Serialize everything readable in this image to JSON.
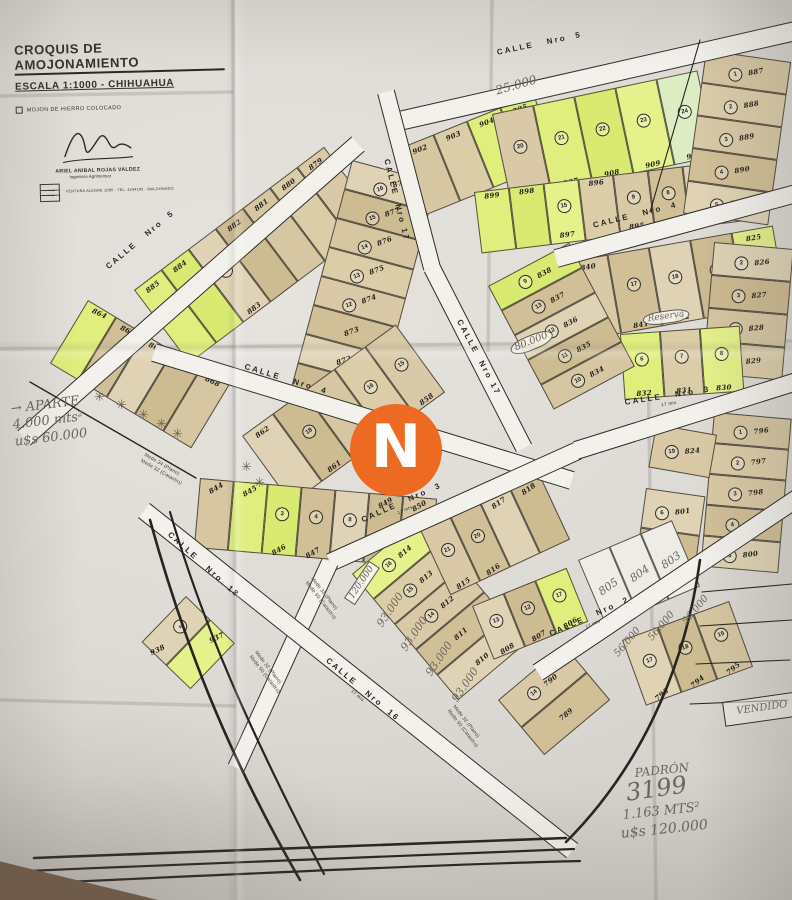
{
  "title_block": {
    "title": "CROQUIS DE AMOJONAMIENTO",
    "subtitle": "ESCALA 1:1000   -   CHIHUAHUA",
    "legend_note": "MOJON DE HIERRO COLOCADO",
    "surveyor_name": "ARIEL ANIBAL ROJAS VALDEZ",
    "surveyor_title": "Ingeniero Agrimensor",
    "surveyor_contact": "VENTURA ALEGRE 1085  -  TEL. 4244100  -  MALDONADO"
  },
  "watermark": {
    "letter": "N",
    "bg": "#EC6A21",
    "fg": "#FFFFFF"
  },
  "palette": {
    "paper": "#e0ddd8",
    "street": "#f3f1ec",
    "line": "#2c2a26",
    "pencil": "#6b655c",
    "tan": [
      "#d9c9a6",
      "#d1bf97",
      "#e0d3b5",
      "#cdbb92",
      "#d6c6a2",
      "#dccda9"
    ],
    "hl": [
      "#e0ee7e",
      "#d9ea72",
      "#e5f18a",
      "#dcedc4"
    ],
    "white_lot": "#eeece7"
  },
  "streets": {
    "bands": [
      {
        "id": "calle-5-top",
        "x1": 386,
        "y1": 124,
        "x2": 800,
        "y2": 30,
        "w": 20
      },
      {
        "id": "calle-5-left",
        "x1": 24,
        "y1": 438,
        "x2": 358,
        "y2": 144,
        "w": 20
      },
      {
        "id": "calle-17-a",
        "x1": 386,
        "y1": 92,
        "x2": 432,
        "y2": 268,
        "w": 18
      },
      {
        "id": "calle-17-b",
        "x1": 432,
        "y1": 268,
        "x2": 524,
        "y2": 448,
        "w": 18
      },
      {
        "id": "calle-4-center",
        "x1": 154,
        "y1": 352,
        "x2": 572,
        "y2": 480,
        "w": 19
      },
      {
        "id": "calle-4-right",
        "x1": 556,
        "y1": 258,
        "x2": 800,
        "y2": 192,
        "w": 19
      },
      {
        "id": "calle-3-center",
        "x1": 578,
        "y1": 450,
        "x2": 330,
        "y2": 562,
        "w": 19
      },
      {
        "id": "calle-3-ext",
        "x1": 330,
        "y1": 562,
        "x2": 236,
        "y2": 768,
        "w": 18
      },
      {
        "id": "calle-3-right",
        "x1": 576,
        "y1": 450,
        "x2": 800,
        "y2": 380,
        "w": 19
      },
      {
        "id": "calle-2",
        "x1": 538,
        "y1": 672,
        "x2": 800,
        "y2": 496,
        "w": 19
      },
      {
        "id": "calle-18-16",
        "x1": 144,
        "y1": 510,
        "x2": 572,
        "y2": 850,
        "w": 19
      }
    ],
    "labels": [
      {
        "text": "CALLE   Nro  5",
        "x": 496,
        "y": 48,
        "rot": -12
      },
      {
        "text": "CALLE   Nro  5",
        "x": 104,
        "y": 264,
        "rot": -40
      },
      {
        "text": "CALLE  Nro 17",
        "x": 391,
        "y": 158,
        "rot": 76
      },
      {
        "text": "CALLE  Nro 17",
        "x": 463,
        "y": 318,
        "rot": 62
      },
      {
        "text": "CALLE   Nro  4",
        "x": 246,
        "y": 362,
        "rot": 17
      },
      {
        "text": "CALLE   Nro  4",
        "x": 592,
        "y": 221,
        "rot": -14
      },
      {
        "text": "CALLE   Nro  3",
        "x": 360,
        "y": 516,
        "rot": -24,
        "wnote": "17 mts"
      },
      {
        "text": "CALLE   Nro  3",
        "x": 624,
        "y": 398,
        "rot": -9,
        "wnote": "17 mts"
      },
      {
        "text": "CALLE   Nro  2",
        "x": 548,
        "y": 630,
        "rot": -24,
        "wnote": "17 mts"
      },
      {
        "text": "CALLE   Nro  18",
        "x": 172,
        "y": 530,
        "rot": 42
      },
      {
        "text": "CALLE   Nro  16",
        "x": 330,
        "y": 656,
        "rot": 40,
        "wnote": "17 mts"
      }
    ]
  },
  "blocks": [
    {
      "id": "mz-879-885",
      "x": 134,
      "y": 290,
      "rot": -37,
      "pw": 34,
      "ph": 92,
      "lots": [
        {
          "n": "885",
          "hl": 1
        },
        {
          "n": "884",
          "hl": 1
        },
        {
          "n": "883",
          "c": "21"
        },
        {
          "n": "882"
        },
        {
          "n": "881"
        },
        {
          "n": "880"
        },
        {
          "n": "879"
        }
      ]
    },
    {
      "id": "col-871-878",
      "x": 352,
      "y": 160,
      "rot": 15,
      "type": "col",
      "cw": 88,
      "ch": 30,
      "ttilt": -35,
      "lots": [
        {
          "n": "878",
          "c": "16"
        },
        {
          "n": "877",
          "c": "15"
        },
        {
          "n": "876",
          "c": "14"
        },
        {
          "n": "875",
          "c": "13"
        },
        {
          "n": "874",
          "c": "12"
        },
        {
          "n": "873"
        },
        {
          "n": "872"
        },
        {
          "n": "871"
        }
      ]
    },
    {
      "id": "mz-902-905",
      "x": 400,
      "y": 148,
      "rot": -22,
      "pw": 36,
      "ph": 72,
      "lots": [
        {
          "n": "902"
        },
        {
          "n": "903"
        },
        {
          "n": "904",
          "hl": 1
        },
        {
          "n": "905",
          "hl": 1
        }
      ]
    },
    {
      "id": "mz-906-910",
      "x": 492,
      "y": 114,
      "rot": -12,
      "pw": 42,
      "ph": 88,
      "lots": [
        {
          "n": "906",
          "c": "20"
        },
        {
          "n": "907",
          "c": "21",
          "hl": 1
        },
        {
          "n": "908",
          "c": "22",
          "hl": 1
        },
        {
          "n": "909",
          "c": "23",
          "hl": 1
        },
        {
          "n": "910",
          "c": "24",
          "hl": 1
        }
      ]
    },
    {
      "id": "mz-892-899",
      "x": 474,
      "y": 192,
      "rot": -7,
      "pw": 35,
      "ph": 62,
      "lpos": "bottom",
      "lots": [
        {
          "n": "899",
          "hl": 1
        },
        {
          "n": "898",
          "hl": 1
        },
        {
          "n": "897",
          "c": "15",
          "hl": 1
        },
        {
          "n": "896"
        },
        {
          "n": "895",
          "c": "9"
        },
        {
          "n": "894",
          "c": "8"
        },
        {
          "n": "893"
        },
        {
          "n": "892"
        }
      ]
    },
    {
      "id": "col-887-891",
      "x": 706,
      "y": 50,
      "rot": 8,
      "type": "col",
      "cw": 86,
      "ch": 33,
      "ttilt": -18,
      "lots": [
        {
          "n": "887",
          "c": "1"
        },
        {
          "n": "888",
          "c": "2"
        },
        {
          "n": "889",
          "c": "3"
        },
        {
          "n": "890",
          "c": "4"
        },
        {
          "n": "891",
          "c": "5"
        }
      ]
    },
    {
      "id": "mz-840-825",
      "x": 566,
      "y": 262,
      "rot": -10,
      "pw": 42,
      "ph": 80,
      "lots": [
        {
          "n": "840"
        },
        {
          "n": "841",
          "c": "17"
        },
        {
          "n": "842",
          "c": "18"
        },
        {
          "n": "843",
          "c": "19"
        },
        {
          "n": "825",
          "hl": 1
        }
      ]
    },
    {
      "id": "col-826-829",
      "x": 714,
      "y": 242,
      "rot": 5,
      "type": "col",
      "cw": 80,
      "ch": 33,
      "ttilt": -10,
      "lots": [
        {
          "n": "826",
          "c": "2"
        },
        {
          "n": "827",
          "c": "3"
        },
        {
          "n": "828",
          "c": "4"
        },
        {
          "n": "829",
          "c": "5"
        }
      ]
    },
    {
      "id": "mz-830-832",
      "x": 620,
      "y": 334,
      "rot": -4,
      "pw": 40,
      "ph": 66,
      "lots": [
        {
          "n": "832",
          "c": "6",
          "hl": 1
        },
        {
          "n": "831",
          "c": "7"
        },
        {
          "n": "830",
          "c": "8",
          "hl": 1
        }
      ]
    },
    {
      "id": "col-834-838",
      "x": 488,
      "y": 286,
      "rot": -28,
      "type": "col",
      "cw": 92,
      "ch": 28,
      "lots": [
        {
          "n": "838",
          "c": "9",
          "hl": 1
        },
        {
          "n": "837",
          "c": "13"
        },
        {
          "n": "836",
          "c": "12"
        },
        {
          "n": "835",
          "c": "11"
        },
        {
          "n": "834",
          "c": "10"
        }
      ]
    },
    {
      "id": "mz-858-862",
      "x": 242,
      "y": 436,
      "rot": -36,
      "pw": 38,
      "ph": 84,
      "lots": [
        {
          "n": "862"
        },
        {
          "n": "861",
          "c": "18"
        },
        {
          "n": "860",
          "c": "17"
        },
        {
          "n": "859",
          "c": "16"
        },
        {
          "n": "858",
          "c": "15"
        }
      ]
    },
    {
      "id": "mz-844-850",
      "x": 200,
      "y": 478,
      "rot": 5,
      "ttilt": -35,
      "pw": 34,
      "ph": 70,
      "lots": [
        {
          "n": "844"
        },
        {
          "n": "845",
          "hl": 1
        },
        {
          "n": "846",
          "c": "3",
          "hl": 1
        },
        {
          "n": "847",
          "c": "4"
        },
        {
          "n": "848",
          "c": "8"
        },
        {
          "n": "849"
        },
        {
          "n": "850"
        }
      ]
    },
    {
      "id": "mz-864-868",
      "x": 88,
      "y": 300,
      "rot": 31,
      "ttilt": -6,
      "pw": 33,
      "ph": 74,
      "lpos": "bottom",
      "lots": [
        {
          "n": "864",
          "hl": 1
        },
        {
          "n": "865"
        },
        {
          "n": "866"
        },
        {
          "n": "867"
        },
        {
          "n": "868"
        }
      ]
    },
    {
      "id": "mz-937-938",
      "x": 186,
      "y": 596,
      "rot": 44,
      "ttilt": -70,
      "pw": 34,
      "ph": 64,
      "lots": [
        {
          "n": "938",
          "c": "3"
        },
        {
          "n": "937",
          "hl": 1
        }
      ]
    },
    {
      "id": "col-810-814",
      "x": 352,
      "y": 574,
      "rot": -40,
      "type": "col",
      "cw": 90,
      "ch": 33,
      "lots": [
        {
          "n": "814",
          "c": "16",
          "hl": 1
        },
        {
          "n": "813",
          "c": "15"
        },
        {
          "n": "812",
          "c": "14"
        },
        {
          "n": "811"
        },
        {
          "n": "810"
        }
      ]
    },
    {
      "id": "col-789-790",
      "x": 498,
      "y": 700,
      "rot": -40,
      "type": "col",
      "cw": 86,
      "ch": 36,
      "lots": [
        {
          "n": "790",
          "c": "14"
        },
        {
          "n": "789"
        }
      ]
    },
    {
      "id": "mz-793-795",
      "x": 622,
      "y": 640,
      "rot": -20,
      "ttilt": -20,
      "pw": 38,
      "ph": 70,
      "lots": [
        {
          "n": "793",
          "c": "17"
        },
        {
          "n": "794",
          "c": "18"
        },
        {
          "n": "795",
          "c": "19"
        }
      ]
    },
    {
      "id": "col-796-800",
      "x": 714,
      "y": 412,
      "rot": 5,
      "type": "col",
      "cw": 78,
      "ch": 31,
      "ttilt": -12,
      "lots": [
        {
          "n": "796",
          "c": "1"
        },
        {
          "n": "797",
          "c": "2"
        },
        {
          "n": "798",
          "c": "3"
        },
        {
          "n": "799",
          "c": "4"
        },
        {
          "n": "800",
          "c": "5"
        }
      ]
    },
    {
      "id": "lot-824",
      "x": 656,
      "y": 424,
      "rot": 10,
      "type": "col",
      "cw": 62,
      "ch": 44,
      "ttilt": -15,
      "lots": [
        {
          "n": "824",
          "c": "19"
        }
      ]
    },
    {
      "id": "col-801-802",
      "x": 646,
      "y": 488,
      "rot": 8,
      "type": "col",
      "cw": 60,
      "ch": 40,
      "ttilt": -15,
      "lots": [
        {
          "n": "801",
          "c": "6"
        },
        {
          "n": "802",
          "c": "7"
        }
      ]
    },
    {
      "id": "mz-803-805",
      "x": 578,
      "y": 560,
      "rot": -23,
      "pw": 34,
      "ph": 72,
      "lots": [
        {
          "n": "805",
          "pencil": 1
        },
        {
          "n": "804",
          "pencil": 1
        },
        {
          "n": "803",
          "pencil": 1
        }
      ]
    },
    {
      "id": "mz-815-818",
      "x": 420,
      "y": 530,
      "rot": -25,
      "ttilt": -10,
      "pw": 33,
      "ph": 72,
      "lots": [
        {
          "n": "815",
          "c": "21"
        },
        {
          "n": "816",
          "c": "20"
        },
        {
          "n": "817"
        },
        {
          "n": "818"
        }
      ]
    },
    {
      "id": "mz-806-808",
      "x": 472,
      "y": 606,
      "rot": -22,
      "ttilt": -10,
      "pw": 34,
      "ph": 58,
      "lots": [
        {
          "n": "808",
          "c": "13"
        },
        {
          "n": "807",
          "c": "12"
        },
        {
          "n": "806",
          "c": "17",
          "hl": 1
        }
      ]
    }
  ],
  "annotations": [
    {
      "text": "25.000",
      "x": 494,
      "y": 84,
      "rot": -16,
      "size": 12
    },
    {
      "text": "80.000",
      "x": 508,
      "y": 344,
      "rot": -22,
      "size": 10,
      "box": "oval"
    },
    {
      "text": "Reserva",
      "x": 642,
      "y": 314,
      "rot": -8,
      "size": 9,
      "box": "oval"
    },
    {
      "text": "120.000",
      "x": 344,
      "y": 598,
      "rot": -56,
      "size": 9,
      "box": "rect"
    },
    {
      "text": "93.000",
      "x": 374,
      "y": 622,
      "rot": -56,
      "size": 11
    },
    {
      "text": "93.000",
      "x": 398,
      "y": 646,
      "rot": -56,
      "size": 11
    },
    {
      "text": "93.000",
      "x": 423,
      "y": 671,
      "rot": -56,
      "size": 11
    },
    {
      "text": "93.000",
      "x": 449,
      "y": 697,
      "rot": -56,
      "size": 11
    },
    {
      "text": "56.000",
      "x": 612,
      "y": 652,
      "rot": -50,
      "size": 10
    },
    {
      "text": "56.000",
      "x": 646,
      "y": 636,
      "rot": -50,
      "size": 10
    },
    {
      "text": "56.000",
      "x": 680,
      "y": 620,
      "rot": -50,
      "size": 10
    },
    {
      "text": "VENDIDO",
      "x": 722,
      "y": 702,
      "rot": -8,
      "size": 10,
      "box": "vendido"
    },
    {
      "lines": [
        "→ APARTE",
        "4.000 mts²",
        "u$s 60.000"
      ],
      "x": 10,
      "y": 402,
      "rot": -7,
      "size": 13
    },
    {
      "text": "PADRÓN",
      "x": 634,
      "y": 766,
      "rot": -6,
      "size": 12
    },
    {
      "text": "3199",
      "x": 624,
      "y": 778,
      "rot": -8,
      "size": 24
    },
    {
      "text": "1.163 MTS²",
      "x": 622,
      "y": 808,
      "rot": -6,
      "size": 13
    },
    {
      "text": "u$s 120.000",
      "x": 620,
      "y": 826,
      "rot": -6,
      "size": 14
    }
  ],
  "tiny_notes": [
    {
      "lines": [
        "Mede 32 (Plano)",
        "Mede 50 (Catastro)"
      ],
      "x": 314,
      "y": 576,
      "rot": 52
    },
    {
      "lines": [
        "Mede 32 (Plano)",
        "Mede 50 (Catastro)"
      ],
      "x": 258,
      "y": 650,
      "rot": 52
    },
    {
      "lines": [
        "Mede 32 (Plano)",
        "Mede 50 (Catastro)"
      ],
      "x": 456,
      "y": 704,
      "rot": 52
    },
    {
      "lines": [
        "Mede 34 (Plano)",
        "Mede 32 (Catastro)"
      ],
      "x": 146,
      "y": 452,
      "rot": 30
    }
  ],
  "stars": [
    {
      "x": 94,
      "y": 390
    },
    {
      "x": 116,
      "y": 398
    },
    {
      "x": 138,
      "y": 408
    },
    {
      "x": 156,
      "y": 417
    },
    {
      "x": 172,
      "y": 427
    },
    {
      "x": 241,
      "y": 460
    },
    {
      "x": 254,
      "y": 476
    }
  ],
  "paths": [
    {
      "d": "M 30 382 L 196 478",
      "sw": 1.4
    },
    {
      "d": "M 150 520 C 182 636 224 748 300 880",
      "sw": 2.6
    },
    {
      "d": "M 170 512 C 202 622 248 728 324 874",
      "sw": 2.2
    },
    {
      "d": "M 34 858 C 230 850 430 843 566 838",
      "sw": 2.6
    },
    {
      "d": "M 28 871 C 230 862 440 853 574 849",
      "sw": 2.2
    },
    {
      "d": "M 22 884 C 240 874 452 864 580 861",
      "sw": 2.2
    },
    {
      "d": "M 700 560 C 688 648 652 756 566 842",
      "sw": 2.6
    },
    {
      "d": "M 702 592 L 792 584",
      "sw": 1.1
    },
    {
      "d": "M 700 626 L 792 620",
      "sw": 1.1
    },
    {
      "d": "M 696 664 L 790 660",
      "sw": 1.1
    },
    {
      "d": "M 690 704 L 788 700",
      "sw": 1.1
    },
    {
      "d": "M 700 40 L 650 212",
      "sw": 1.1
    }
  ],
  "creases": [
    {
      "x1": 233,
      "y1": 0,
      "x2": 236,
      "y2": 900
    },
    {
      "x1": 492,
      "y1": 0,
      "x2": 488,
      "y2": 352
    },
    {
      "x1": 0,
      "y1": 96,
      "x2": 233,
      "y2": 92
    },
    {
      "x1": 0,
      "y1": 349,
      "x2": 792,
      "y2": 341
    },
    {
      "x1": 0,
      "y1": 700,
      "x2": 236,
      "y2": 706
    },
    {
      "x1": 648,
      "y1": 356,
      "x2": 656,
      "y2": 900
    }
  ]
}
